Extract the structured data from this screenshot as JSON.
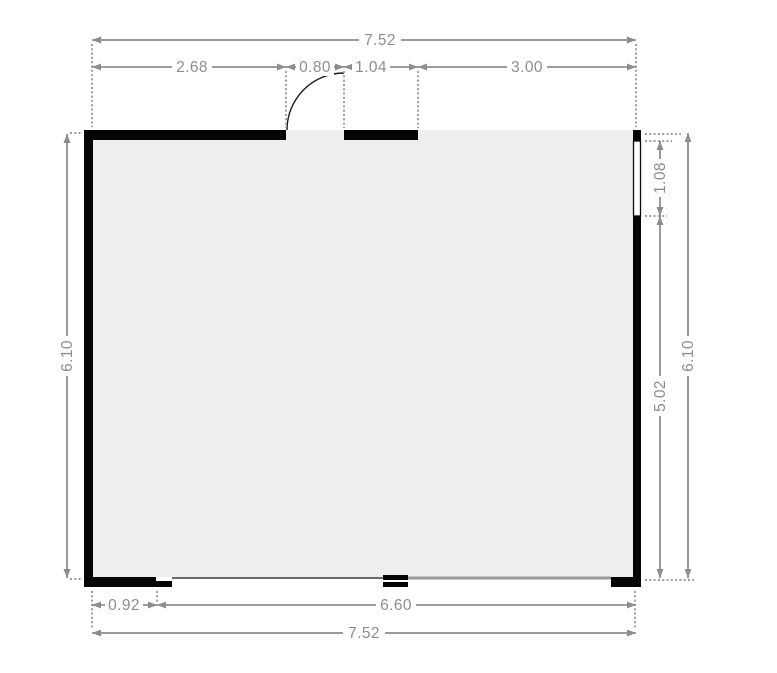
{
  "plan": {
    "colors": {
      "wall": "#050505",
      "floor": "#eeeeee",
      "dimension_gray": "#8d8d8d",
      "boundary_light_gray": "#9b9b9b",
      "window_fill": "#ffffff"
    },
    "dimensions": {
      "top_total": "7.52",
      "top_seg1": "2.68",
      "top_seg2": "0.80",
      "top_seg3": "1.04",
      "top_seg4": "3.00",
      "left_total": "6.10",
      "right_seg1": "1.08",
      "right_seg2": "5.02",
      "right_total": "6.10",
      "bottom_seg1": "0.92",
      "bottom_seg2": "6.60",
      "bottom_total": "7.52"
    },
    "features": {
      "door": "hinged-door",
      "window": "window",
      "room": "room"
    }
  }
}
